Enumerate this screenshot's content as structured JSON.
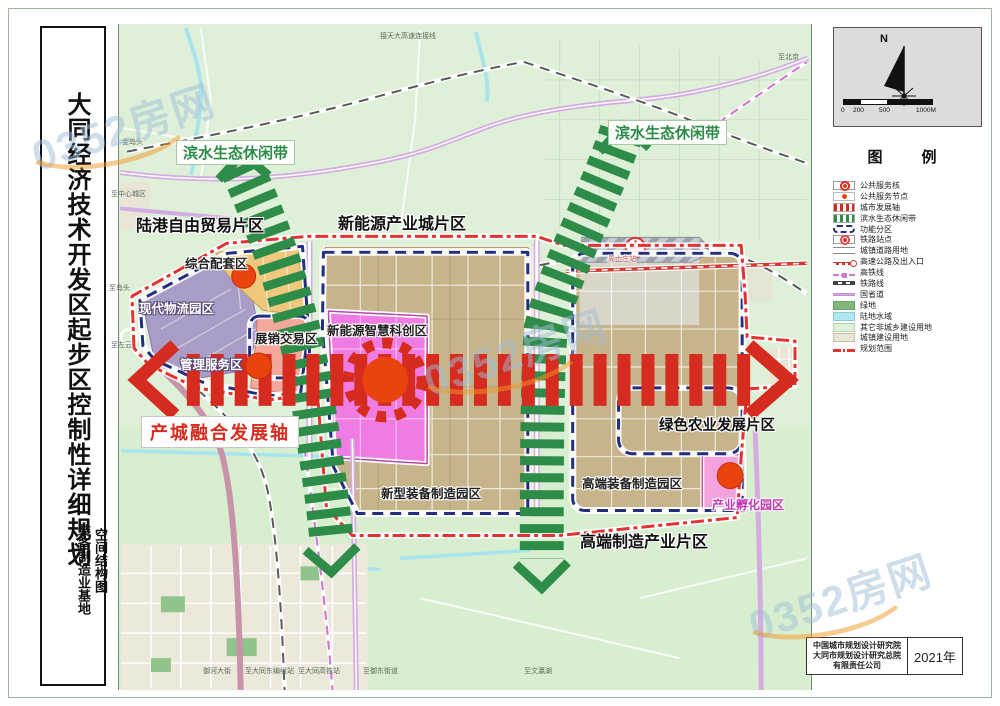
{
  "sidebar": {
    "title": "大同经济技术开发区起步区控制性详细规划",
    "subtitle_left": "装备制造业基地",
    "subtitle_right": "空间结构图"
  },
  "north": {
    "label": "N"
  },
  "scalebar": {
    "ticks": [
      "0",
      "200",
      "500",
      "1000M"
    ]
  },
  "legend": {
    "title": "图　例",
    "items": [
      "公共服务核",
      "公共服务节点",
      "城市发展轴",
      "滨水生态休闲带",
      "功能分区",
      "铁路站点",
      "城镇道路用地",
      "高速公路及出入口",
      "高铁线",
      "铁路线",
      "国省道",
      "绿地",
      "陆地水域",
      "其它非城乡建设用地",
      "城镇建设用地",
      "规划范围"
    ]
  },
  "attribution": {
    "line1": "中国城市规划设计研究院",
    "line2": "大同市规划设计研究总院",
    "line3": "有限责任公司",
    "year": "2021年"
  },
  "watermark": {
    "text": "0352房网"
  },
  "map_labels": {
    "eco_west": {
      "text": "滨水生态休闲带"
    },
    "eco_east": {
      "text": "滨水生态休闲带"
    },
    "district_nw": {
      "text": "陆港自由贸易片区"
    },
    "district_n": {
      "text": "新能源产业城片区"
    },
    "district_s": {
      "text": "高端制造产业片区"
    },
    "axis": {
      "text": "产城融合发展轴"
    },
    "zone_complex": {
      "text": "综合配套区"
    },
    "zone_logistics": {
      "text": "现代物流园区"
    },
    "zone_expo": {
      "text": "展销交易区"
    },
    "zone_admin": {
      "text": "管理服务区"
    },
    "zone_tech": {
      "text": "新能源智慧科创区"
    },
    "zone_newequip": {
      "text": "新型装备制造园区"
    },
    "zone_highequip": {
      "text": "高端装备制造园区"
    },
    "zone_agri": {
      "text": "绿色农业发展片区"
    },
    "zone_incubator": {
      "text": "产业孵化园区"
    },
    "station": {
      "text": "周士庄站"
    }
  },
  "minor_labels": [
    "金岛头",
    "至中心城区",
    "至岛头",
    "至左云",
    "接天大高速连接线",
    "至北京",
    "御河大街",
    "至大同东编组站",
    "至大同高铁站",
    "至御东街道",
    "至文瀛湖"
  ],
  "colors": {
    "axis_red": "#d62b1f",
    "eco_green": "#2e8c49",
    "zone_navy": "#232e7e",
    "boundary_red": "#e23232",
    "tech_magenta": "#ef7ce2",
    "core_red": "#e9430e"
  }
}
